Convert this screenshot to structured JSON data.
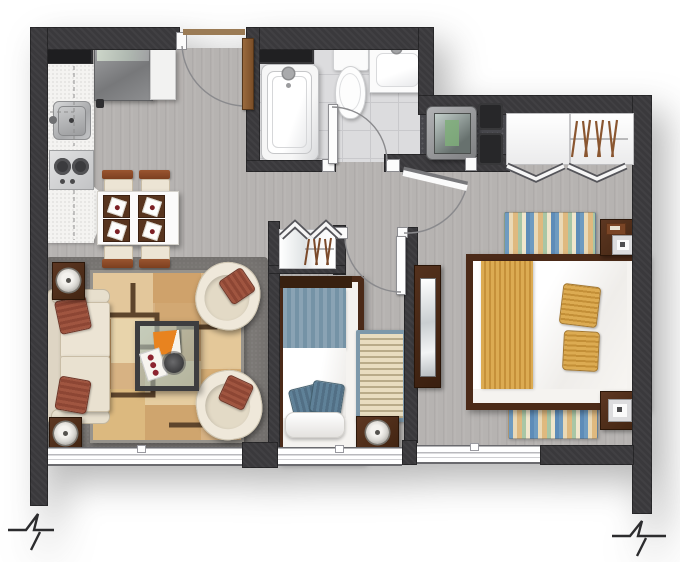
{
  "meta": {
    "kind": "apartment-floor-plan",
    "view": "top-down-render",
    "width_px": 680,
    "height_px": 562,
    "visible_text": ""
  },
  "colors": {
    "wall": "#3a393c",
    "floor": "#b6b3b1",
    "floor_dark": "#7f7c79",
    "tile": "#dcdcde",
    "niche": "#47474c",
    "counter": "#f4f3f1",
    "glass": "#ffffff",
    "wood_dark": "#4b2a18",
    "wood_mid": "#6b4226",
    "cream": "#ece4d4",
    "rust": "#994e38",
    "rug_tan": "#d7b283",
    "blue": "#7e99ab",
    "blue_dark": "#5d7f96",
    "gold": "#d9a84e"
  },
  "rooms": {
    "kitchen": {
      "furniture": [
        "wall-cabinet",
        "counter-l-shaped",
        "sink",
        "cooktop-two-burners",
        "refrigerator-with-open-door"
      ]
    },
    "dining": {
      "furniture": [
        "table-for-four",
        "chair x4",
        "placemat-with-plate x4"
      ]
    },
    "living": {
      "furniture": [
        "sofa-two-seat",
        "rust-pillow x2",
        "armchair x2",
        "coffee-table-glass",
        "patchwork-rug",
        "side-table-with-lamp x2",
        "dark-carpet"
      ]
    },
    "bathroom": {
      "furniture": [
        "bathtub",
        "toilet",
        "washbasin",
        "wall-recess-shelf"
      ]
    },
    "hallway": {
      "furniture": [
        "closet-with-hangers-bifold-doors"
      ]
    },
    "bedroom_small": {
      "furniture": [
        "single-bed-blue",
        "striped-rug",
        "nightstand-with-lamp"
      ]
    },
    "bedroom_master": {
      "furniture": [
        "double-bed-gold-runner",
        "gold-pillow x2",
        "striped-rug x2",
        "nightstand-with-lamp x2",
        "tv-niche-with-tv-and-speakers",
        "closet-with-hangers-bifold-doors",
        "mirror-dresser"
      ]
    }
  },
  "openings": {
    "entry_door": "top-wall, wood leaf, quarter-swing-arc",
    "bathroom_door": "swing-in, white leaf",
    "master_bedroom_door": "swing-in, white leaf, partially open",
    "small_bedroom_door": "swing-in, white leaf",
    "windows": 3,
    "wall_break_symbols": 2
  }
}
